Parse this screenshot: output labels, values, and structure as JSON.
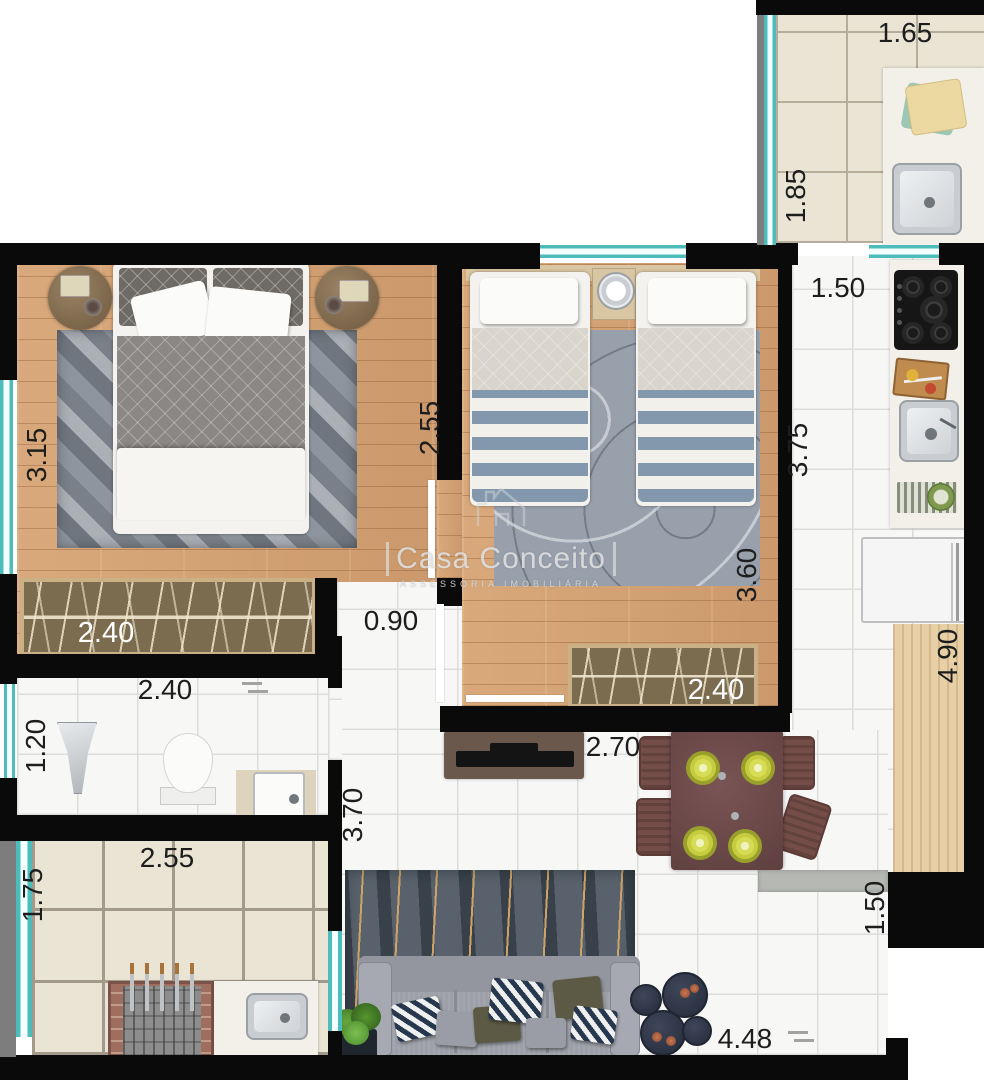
{
  "watermark": {
    "brand": "Casa Conceito",
    "subtitle": "ASSESSORIA IMOBILIÁRIA"
  },
  "labels": {
    "service_width": "1.65",
    "service_depth": "1.85",
    "kitchen_width": "1.50",
    "kitchen_depth": "3.75",
    "kitchen_counter_length": "4.90",
    "master_depth": "3.15",
    "master_width": "2.55",
    "master_wardrobe_width": "2.40",
    "bedroom2_depth": "3.60",
    "bedroom2_wardrobe_width": "2.40",
    "hall_width": "0.90",
    "bathroom_width": "2.40",
    "bathroom_depth": "1.20",
    "balcony_width": "2.55",
    "balcony_depth": "1.75",
    "living_depth": "3.70",
    "living_tv_wall": "2.70",
    "living_width": "4.48",
    "living_entry_depth": "1.50"
  },
  "colors": {
    "wall": "#0a0a0a",
    "window_teal": "#4dbdbc",
    "window_frame_gray": "#7d7d7d",
    "wood_floor": "#d2a072",
    "counter_wood": "#e7cfa6",
    "tile_beige": "#eae4d4",
    "grout_beige": "#b5ac9a",
    "tile_white": "#f7f7f6",
    "grout_white": "#dcdcda",
    "wardrobe_brown": "#7b6c50",
    "wardrobe_trim": "#c9b185",
    "rug_gray": "#98a0ac",
    "rug_dark": "#59626c",
    "rug_gold": "#cda468",
    "sofa_gray": "#9da0a8",
    "dining_table": "#6d4a49",
    "plate_green": "#c6cc3e",
    "coffee_table_navy": "#333b4d",
    "plant_green": "#55952f",
    "label_text": "#1d1d1d"
  },
  "furniture_icons": [
    "double-bed-icon",
    "nightstand-icon",
    "wardrobe-icon",
    "twin-bed-icon",
    "clock-icon",
    "rug-icon",
    "cooktop-icon",
    "cutting-board-icon",
    "kitchen-sink-icon",
    "dish-rack-icon",
    "refrigerator-icon",
    "bar-counter-icon",
    "laundry-sink-icon",
    "towel-stack-icon",
    "shower-icon",
    "toilet-icon",
    "plant-icon",
    "bathroom-sink-icon",
    "bbq-grill-icon",
    "tv-stand-icon",
    "dining-table-icon",
    "chair-icon",
    "plate-icon",
    "sofa-icon",
    "pillow-icon",
    "coffee-table-icon",
    "door-swing-icon",
    "house-logo-icon"
  ]
}
